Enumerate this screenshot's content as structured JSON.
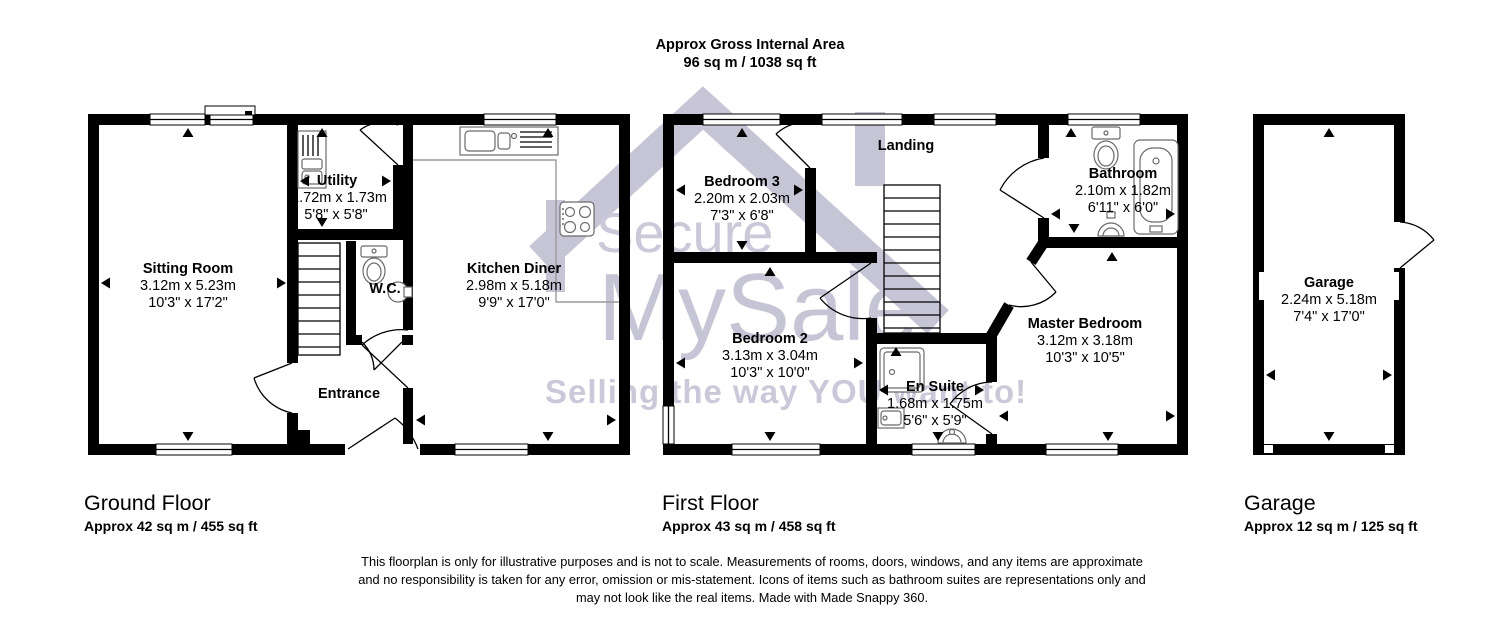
{
  "header": {
    "line1": "Approx Gross Internal Area",
    "line2": "96 sq m / 1038 sq ft"
  },
  "watermark": {
    "brand_top": "Secure",
    "brand_bottom": "MySale",
    "tagline": "Selling the way YOU want to!",
    "color": "#c4c2d4"
  },
  "ground_floor": {
    "title": "Ground Floor",
    "area": "Approx 42 sq m / 455 sq ft",
    "rooms": {
      "sitting_room": {
        "name": "Sitting Room",
        "metric": "3.12m x 5.23m",
        "imperial": "10'3\" x 17'2\""
      },
      "utility": {
        "name": "Utility",
        "metric": "1.72m x 1.73m",
        "imperial": "5'8\" x 5'8\""
      },
      "wc": {
        "name": "W.C."
      },
      "kitchen_diner": {
        "name": "Kitchen Diner",
        "metric": "2.98m x 5.18m",
        "imperial": "9'9\" x 17'0\""
      },
      "entrance": {
        "name": "Entrance"
      }
    }
  },
  "first_floor": {
    "title": "First Floor",
    "area": "Approx 43 sq m / 458 sq ft",
    "rooms": {
      "bedroom3": {
        "name": "Bedroom 3",
        "metric": "2.20m x 2.03m",
        "imperial": "7'3\" x 6'8\""
      },
      "landing": {
        "name": "Landing"
      },
      "bathroom": {
        "name": "Bathroom",
        "metric": "2.10m x 1.82m",
        "imperial": "6'11\" x 6'0\""
      },
      "bedroom2": {
        "name": "Bedroom 2",
        "metric": "3.13m x 3.04m",
        "imperial": "10'3\" x 10'0\""
      },
      "master_bedroom": {
        "name": "Master Bedroom",
        "metric": "3.12m x 3.18m",
        "imperial": "10'3\" x 10'5\""
      },
      "en_suite": {
        "name": "En Suite",
        "metric": "1.68m x 1.75m",
        "imperial": "5'6\" x 5'9\""
      }
    }
  },
  "garage_block": {
    "title": "Garage",
    "area": "Approx 12 sq m / 125 sq ft",
    "rooms": {
      "garage": {
        "name": "Garage",
        "metric": "2.24m x 5.18m",
        "imperial": "7'4\" x 17'0\""
      }
    }
  },
  "disclaimer": {
    "line1": "This floorplan is only for illustrative purposes and is not to scale. Measurements of rooms, doors, windows, and any items are approximate",
    "line2": "and no responsibility is taken for any error, omission or mis-statement. Icons of items such as bathroom suites are representations only and",
    "line3": "may not look like the real items. Made with Made Snappy 360."
  },
  "colors": {
    "wall": "#000000",
    "watermark": "#c4c2d4",
    "fixture": "#6b6b6b"
  }
}
